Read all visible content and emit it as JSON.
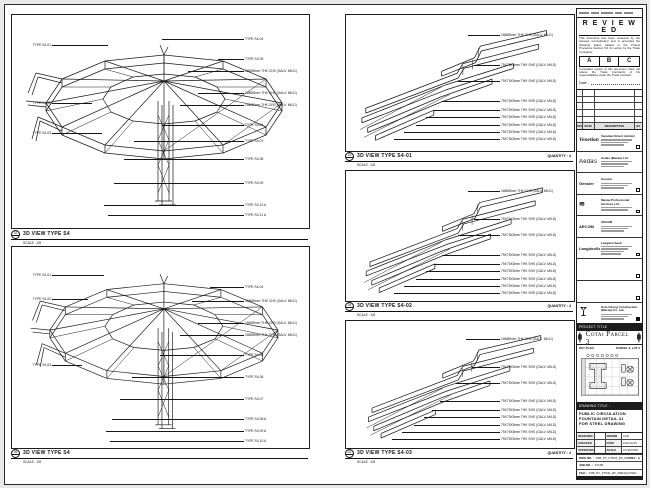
{
  "panels": [
    {
      "key": "left-top",
      "bubble": "22",
      "title": "3D VIEW TYPE S4",
      "scale": "SCALE : 1/8",
      "quantity": "",
      "ann": [
        {
          "s": "L",
          "y": 30,
          "lx": 96,
          "t": "TYPE S4-01"
        },
        {
          "s": "L",
          "y": 88,
          "lx": 80,
          "t": "TYPE S4-02"
        },
        {
          "s": "L",
          "y": 118,
          "lx": 90,
          "t": "TYPE S4-03"
        },
        {
          "s": "R",
          "y": 24,
          "lx": 150,
          "t": "TYPE S4-04"
        },
        {
          "s": "R",
          "y": 44,
          "lx": 206,
          "t": "TYPE S4-05"
        },
        {
          "s": "R",
          "y": 56,
          "lx": 176,
          "t": "168Ø8mm THK CHS (GALV. MILD)"
        },
        {
          "s": "R",
          "y": 78,
          "lx": 186,
          "t": "168Ø8mm THK CHS (GALV. MILD)"
        },
        {
          "s": "R",
          "y": 90,
          "lx": 168,
          "t": "168Ø8mm THK CHS (GALV. MILD)"
        },
        {
          "s": "R",
          "y": 110,
          "lx": 150,
          "t": "TYPE S4-06"
        },
        {
          "s": "R",
          "y": 126,
          "lx": 122,
          "t": "TYPE S4-07"
        },
        {
          "s": "R",
          "y": 144,
          "lx": 112,
          "t": "TYPE S4-08"
        },
        {
          "s": "R",
          "y": 168,
          "lx": 102,
          "t": "TYPE S4-09"
        },
        {
          "s": "R",
          "y": 190,
          "lx": 92,
          "t": "TYPE S4-10 A"
        },
        {
          "s": "R",
          "y": 200,
          "lx": 96,
          "t": "TYPE S4-11 A"
        }
      ]
    },
    {
      "key": "left-bottom",
      "bubble": "26",
      "title": "3D VIEW TYPE S4",
      "scale": "SCALE : 1/8",
      "quantity": "",
      "ann": [
        {
          "s": "L",
          "y": 28,
          "lx": 92,
          "t": "TYPE S4-01"
        },
        {
          "s": "L",
          "y": 52,
          "lx": 76,
          "t": "TYPE S4-02"
        },
        {
          "s": "L",
          "y": 118,
          "lx": 70,
          "t": "TYPE S4-03"
        },
        {
          "s": "R",
          "y": 40,
          "lx": 198,
          "t": "TYPE S4-04"
        },
        {
          "s": "R",
          "y": 54,
          "lx": 180,
          "t": "168Ø8mm THK CHS (GALV. MILD)"
        },
        {
          "s": "R",
          "y": 76,
          "lx": 186,
          "t": "168Ø8mm THK CHS (GALV. MILD)"
        },
        {
          "s": "R",
          "y": 88,
          "lx": 168,
          "t": "168Ø8mm THK CHS (GALV. MILD)"
        },
        {
          "s": "R",
          "y": 108,
          "lx": 148,
          "t": "TYPE S4-05"
        },
        {
          "s": "R",
          "y": 130,
          "lx": 120,
          "t": "TYPE S4-06"
        },
        {
          "s": "R",
          "y": 152,
          "lx": 108,
          "t": "TYPE S4-07"
        },
        {
          "s": "R",
          "y": 172,
          "lx": 100,
          "t": "TYPE S4-08 A"
        },
        {
          "s": "R",
          "y": 184,
          "lx": 94,
          "t": "TYPE S4-09 A"
        },
        {
          "s": "R",
          "y": 194,
          "lx": 98,
          "t": "TYPE S4-10 A"
        }
      ]
    },
    {
      "key": "mid-top",
      "bubble": "23",
      "title": "3D VIEW TYPE S4-01",
      "scale": "SCALE : 1/8",
      "quantity": "QUANTITY : 4",
      "ann": [
        {
          "s": "R",
          "y": 20,
          "lx": 122,
          "t": "168Ø8mm THK CHS (GALV. MILD)"
        },
        {
          "s": "R",
          "y": 50,
          "lx": 128,
          "t": "75X75X5mm THK SHS (GALV. MILD)"
        },
        {
          "s": "R",
          "y": 66,
          "lx": 112,
          "t": "75X75X5mm THK SHS (GALV. MILD)"
        },
        {
          "s": "R",
          "y": 86,
          "lx": 96,
          "t": "75X75X5mm THK SHS (GALV. MILD)"
        },
        {
          "s": "R",
          "y": 95,
          "lx": 88,
          "t": "75X75X5mm THK SHS (GALV. MILD)"
        },
        {
          "s": "R",
          "y": 102,
          "lx": 80,
          "t": "75X75X5mm THK SHS (GALV. MILD)"
        },
        {
          "s": "R",
          "y": 110,
          "lx": 70,
          "t": "75X75X5mm THK SHS (GALV. MILD)"
        },
        {
          "s": "R",
          "y": 117,
          "lx": 58,
          "t": "75X75X5mm THK SHS (GALV. MILD)"
        },
        {
          "s": "R",
          "y": 124,
          "lx": 48,
          "t": "75X75X5mm THK SHS (GALV. MILD)"
        }
      ]
    },
    {
      "key": "mid-middle",
      "bubble": "24",
      "title": "3D VIEW TYPE S4-02",
      "scale": "SCALE : 1/8",
      "quantity": "QUANTITY : 4",
      "ann": [
        {
          "s": "R",
          "y": 20,
          "lx": 122,
          "t": "168Ø8mm THK CHS (GALV. MILD)"
        },
        {
          "s": "R",
          "y": 48,
          "lx": 128,
          "t": "75X75X5mm THK SHS (GALV. MILD)"
        },
        {
          "s": "R",
          "y": 64,
          "lx": 112,
          "t": "75X75X5mm THK SHS (GALV. MILD)"
        },
        {
          "s": "R",
          "y": 84,
          "lx": 96,
          "t": "75X75X5mm THK SHS (GALV. MILD)"
        },
        {
          "s": "R",
          "y": 93,
          "lx": 88,
          "t": "75X75X5mm THK SHS (GALV. MILD)"
        },
        {
          "s": "R",
          "y": 100,
          "lx": 80,
          "t": "75X75X5mm THK SHS (GALV. MILD)"
        },
        {
          "s": "R",
          "y": 108,
          "lx": 70,
          "t": "75X75X5mm THK SHS (GALV. MILD)"
        },
        {
          "s": "R",
          "y": 115,
          "lx": 58,
          "t": "75X75X5mm THK SHS (GALV. MILD)"
        },
        {
          "s": "R",
          "y": 122,
          "lx": 48,
          "t": "75X75X5mm THK SHS (GALV. MILD)"
        }
      ]
    },
    {
      "key": "mid-bottom",
      "bubble": "25",
      "title": "3D VIEW TYPE S4-03",
      "scale": "SCALE : 1/8",
      "quantity": "QUANTITY : 4",
      "ann": [
        {
          "s": "R",
          "y": 18,
          "lx": 120,
          "t": "168Ø8mm THK CHS (GALV. MILD)"
        },
        {
          "s": "R",
          "y": 46,
          "lx": 126,
          "t": "75X75X5mm THK SHS (GALV. MILD)"
        },
        {
          "s": "R",
          "y": 62,
          "lx": 110,
          "t": "75X75X5mm THK SHS (GALV. MILD)"
        },
        {
          "s": "R",
          "y": 80,
          "lx": 94,
          "t": "75X75X5mm THK SHS (GALV. MILD)"
        },
        {
          "s": "R",
          "y": 89,
          "lx": 86,
          "t": "75X75X5mm THK SHS (GALV. MILD)"
        },
        {
          "s": "R",
          "y": 96,
          "lx": 78,
          "t": "75X75X5mm THK SHS (GALV. MILD)"
        },
        {
          "s": "R",
          "y": 104,
          "lx": 68,
          "t": "75X75X5mm THK SHS (GALV. MILD)"
        },
        {
          "s": "R",
          "y": 111,
          "lx": 56,
          "t": "75X75X5mm THK SHS (GALV. MILD)"
        },
        {
          "s": "R",
          "y": 118,
          "lx": 46,
          "t": "75X75X5mm THK SHS (GALV. MILD)"
        }
      ]
    }
  ],
  "title_block": {
    "stamp": {
      "title": "R E V I E W E D",
      "para1": "This document has been reviewed by the relevant Consultant(s) and is accorded the following status relative to the Project Procedure Section 5.4 for action by the Trade Contractor.",
      "grades": [
        "A",
        "B",
        "C"
      ],
      "para2": "Consultant review of this document does not relieve the Trade Contractor of his responsibilities under the Trade Contract.",
      "date_label": "Date :"
    },
    "revision_headers": [
      "REV",
      "DATE",
      "DESCRIPTION",
      "BY"
    ],
    "revision_empty_rows": 5,
    "consultants": [
      {
        "logo": "Venetian",
        "style": "script",
        "name": "Venetian Orient Limited",
        "addr_lines": 3,
        "checkbox": "empty"
      },
      {
        "logo": "Aedas",
        "style": "lite",
        "name": "Aedas (Macau) Ltd.",
        "addr_lines": 3,
        "checkbox": "none"
      },
      {
        "logo": "Gensler",
        "style": "tiny",
        "name": "Gensler",
        "addr_lines": 3,
        "checkbox": "empty"
      },
      {
        "logo": "≋",
        "style": "waves",
        "name": "Macau Professional Services Ltd.",
        "addr_lines": 2,
        "checkbox": "empty"
      },
      {
        "logo": "AECOM",
        "style": "tiny",
        "name": "AECOM",
        "addr_lines": 3,
        "checkbox": "none"
      },
      {
        "logo": "LangdonSeah",
        "style": "tiny",
        "name": "Langdon Seah",
        "addr_lines": 4,
        "checkbox": "empty"
      },
      {
        "logo": "",
        "style": "",
        "name": "",
        "addr_lines": 0,
        "checkbox": "empty"
      },
      {
        "logo": "",
        "style": "",
        "name": "",
        "addr_lines": 0,
        "checkbox": "empty"
      },
      {
        "logo": "",
        "style": "glass",
        "name": "Hsin Chong Construction (Macau) Co. Ltd.",
        "addr_lines": 3,
        "checkbox": "filled"
      }
    ],
    "project": {
      "bar": "PROJECT TITLE",
      "name": "Cotai Parcel 3"
    },
    "key_plan": {
      "left": "KEY PLAN",
      "right": "PARCEL 3, LOT 2"
    },
    "drawing_title": {
      "bar": "DRAWING TITLE :",
      "lines": [
        "PUBLIC CIRCULATION",
        "FOUNTAIN DETAIL 31",
        "FOR STEEL DRAWING"
      ]
    },
    "approvals": [
      [
        "DESIGNED",
        "-",
        "DRAWN",
        "CAD"
      ],
      [
        "CHECKED",
        "-",
        "DATE",
        "14/AUG/15"
      ],
      [
        "APPROVED",
        "-",
        "SCALE",
        "AS SHOWN"
      ]
    ],
    "doc_rows": [
      {
        "l": "DWG NO. :",
        "v": "P3B_PC_FTD31_RF_M004",
        "r": "REV : A"
      },
      {
        "l": "JOB NO. :",
        "v": "3712B",
        "r": ""
      },
      {
        "l": "FILE :",
        "v": "P3B_PC_FTD31_RF_M004(A).DWG",
        "r": ""
      }
    ]
  }
}
